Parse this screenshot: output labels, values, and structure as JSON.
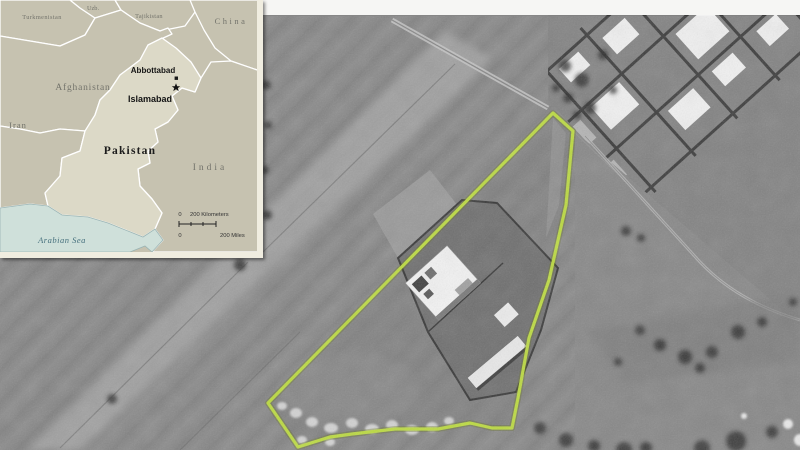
{
  "inset_map": {
    "labels": {
      "turkmenistan": "Turkmenistan",
      "uzbekistan": "Uzb.",
      "tajikistan": "Tajikistan",
      "china": "China",
      "afghanistan": "Afghanistan",
      "iran": "Iran",
      "pakistan": "Pakistan",
      "india": "India",
      "arabian_sea": "Arabian Sea",
      "abbottabad": "Abbottabad",
      "islamabad": "Islamabad"
    },
    "scale": {
      "km_zero": "0",
      "km_label": "200 Kilometers",
      "mi_zero": "0",
      "mi_label": "200 Miles"
    },
    "icons": {
      "islamabad_marker": "star-icon",
      "abbottabad_marker": "square-dot-icon"
    },
    "colors": {
      "land": "#c6c2b0",
      "pakistan": "#dcd9c7",
      "water": "#cfe0da",
      "border": "#ffffff",
      "frame": "#f0ede0",
      "country_label": "#73736b",
      "sea_label": "#46707d",
      "city_label": "#141414"
    }
  },
  "satellite_view": {
    "compound_outline_color": "#bcdb3f",
    "tones": {
      "base": "#878787",
      "dark_walls": "#343434",
      "buildings": "#f3f3f3",
      "top_strip": "#f6f6f4"
    }
  }
}
